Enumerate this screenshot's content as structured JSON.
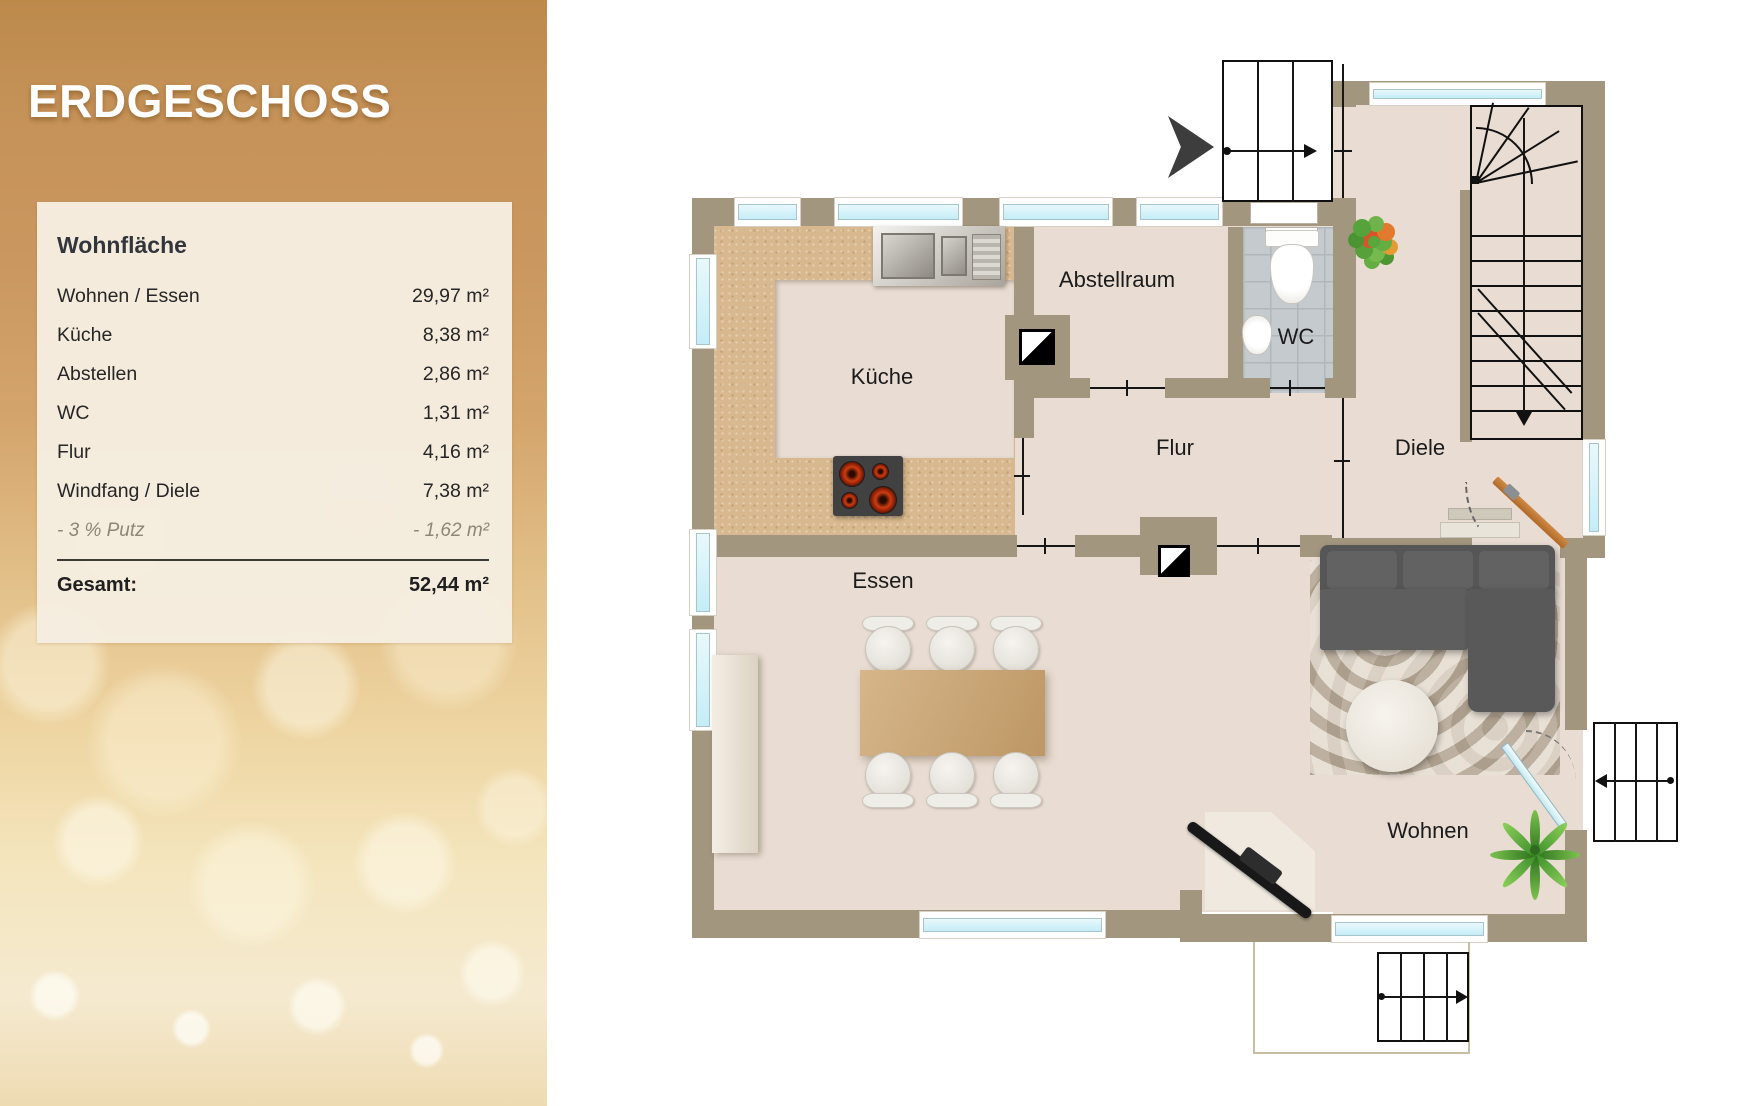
{
  "sidebar": {
    "title": "ERDGESCHOSS",
    "card": {
      "heading": "Wohnfläche",
      "rows": [
        {
          "label": "Wohnen / Essen",
          "value": "29,97 m²"
        },
        {
          "label": "Küche",
          "value": "8,38 m²"
        },
        {
          "label": "Abstellen",
          "value": "2,86 m²"
        },
        {
          "label": "WC",
          "value": "1,31 m²"
        },
        {
          "label": "Flur",
          "value": "4,16 m²"
        },
        {
          "label": "Windfang / Diele",
          "value": "7,38 m²"
        }
      ],
      "deduction": {
        "label": "- 3 % Putz",
        "value": "- 1,62 m²"
      },
      "total_label": "Gesamt:",
      "total_value": "52,44 m²"
    }
  },
  "plan": {
    "room_labels": {
      "kueche": "Küche",
      "abstellraum": "Abstellraum",
      "wc": "WC",
      "flur": "Flur",
      "diele": "Diele",
      "essen": "Essen",
      "wohnen": "Wohnen"
    }
  },
  "colors": {
    "gold": "#cd9c63",
    "card_bg": "#f5eddf",
    "wall": "#a3967f",
    "floor": "#e9ddd3",
    "kitchen_counter": "#d8b88e",
    "window_pane": "#cdeef6",
    "entry_door": "#c27a35",
    "wc_tile": "#c4cacd",
    "sofa": "#565656"
  }
}
